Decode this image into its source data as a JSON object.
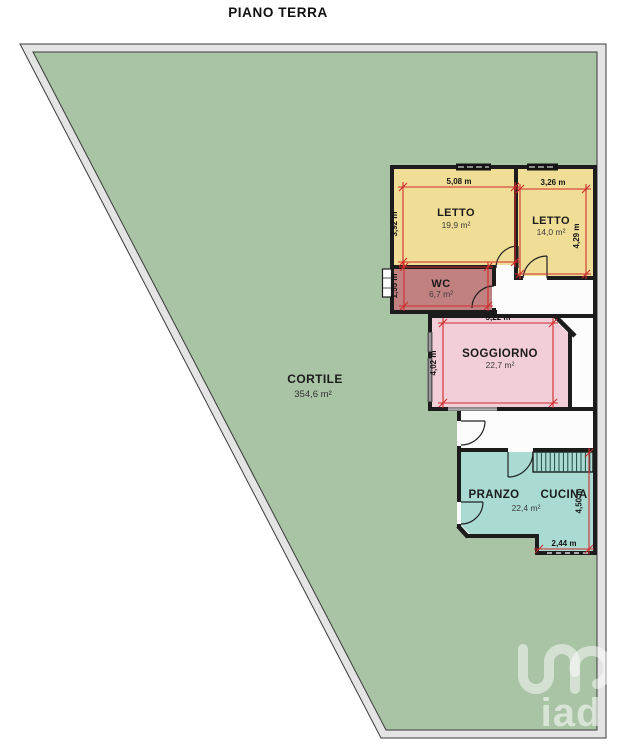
{
  "title": "PIANO TERRA",
  "colors": {
    "courtyard": "#a9c3a5",
    "boundary": "#e4e4e4",
    "bedroom": "#f0de96",
    "wc": "#c28181",
    "living": "#f2ced8",
    "kitchen": "#aadbd2",
    "floor": "#fcfcfc",
    "wall": "#1c1c1c",
    "dimension": "#cf2b2b"
  },
  "rooms": {
    "cortile": {
      "name": "CORTILE",
      "area": "354,6 m²"
    },
    "letto1": {
      "name": "LETTO",
      "area": "19,9 m²"
    },
    "letto2": {
      "name": "LETTO",
      "area": "14,0 m²"
    },
    "wc": {
      "name": "WC",
      "area": "6,7 m²"
    },
    "soggiorno": {
      "name": "SOGGIORNO",
      "area": "22,7 m²"
    },
    "pranzo_cucina": {
      "name_left": "PRANZO",
      "name_right": "CUCINA",
      "area": "22,4 m²"
    }
  },
  "dimensions": {
    "letto1_width": "5,08 m",
    "letto1_depth": "3,92 m",
    "letto2_width": "3,26 m",
    "letto2_depth": "4,29 m",
    "wc_depth": "1,55 m",
    "soggiorno_width": "5,22 m",
    "soggiorno_depth": "4,02 m",
    "kitchen_depth": "4,50 m",
    "kitchen_bottom_width": "2,44 m"
  },
  "logo": {
    "text": "iad"
  }
}
